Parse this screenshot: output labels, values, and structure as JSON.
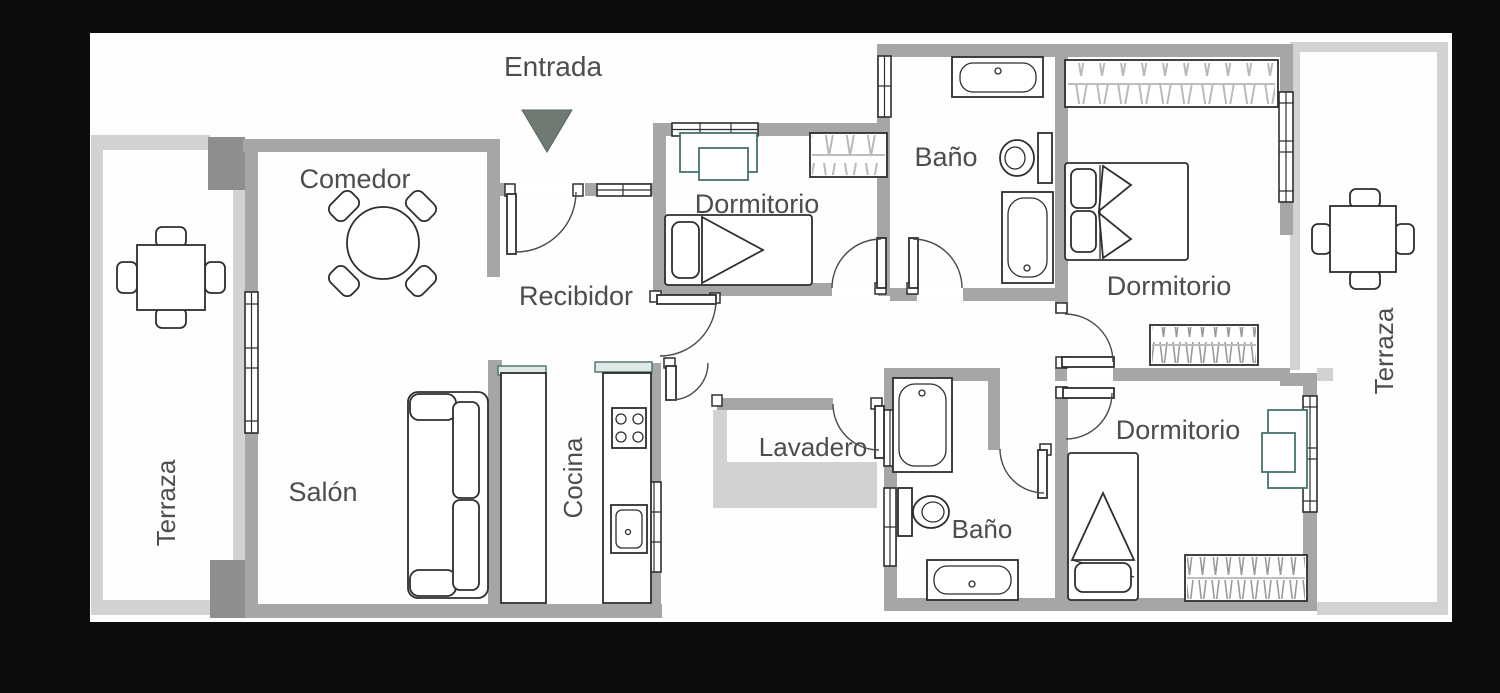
{
  "plan": {
    "type": "apartment-floor-plan",
    "colors": {
      "background": "#0d0d0d",
      "floor": "#fefefe",
      "wall": "#a6a6a6",
      "light_wall": "#d2d2d2",
      "pillar": "#8e8e8e",
      "entry_arrow": "#6f7a73",
      "label": "#4d4d4d",
      "furniture_stroke": "#2e2e2e",
      "accent_teal": "#46736f",
      "hanger_light": "#b9b9b9",
      "hanger_dark": "#9a9a9a"
    }
  },
  "labels": {
    "entrada": "Entrada",
    "comedor": "Comedor",
    "recibidor": "Recibidor",
    "dormitorio_top": "Dormitorio",
    "bano_top": "Baño",
    "dormitorio_right": "Dormitorio",
    "terraza_right": "Terraza",
    "terraza_left": "Terraza",
    "salon": "Salón",
    "cocina": "Cocina",
    "lavadero": "Lavadero",
    "bano_bottom": "Baño",
    "dormitorio_bottom": "Dormitorio"
  }
}
